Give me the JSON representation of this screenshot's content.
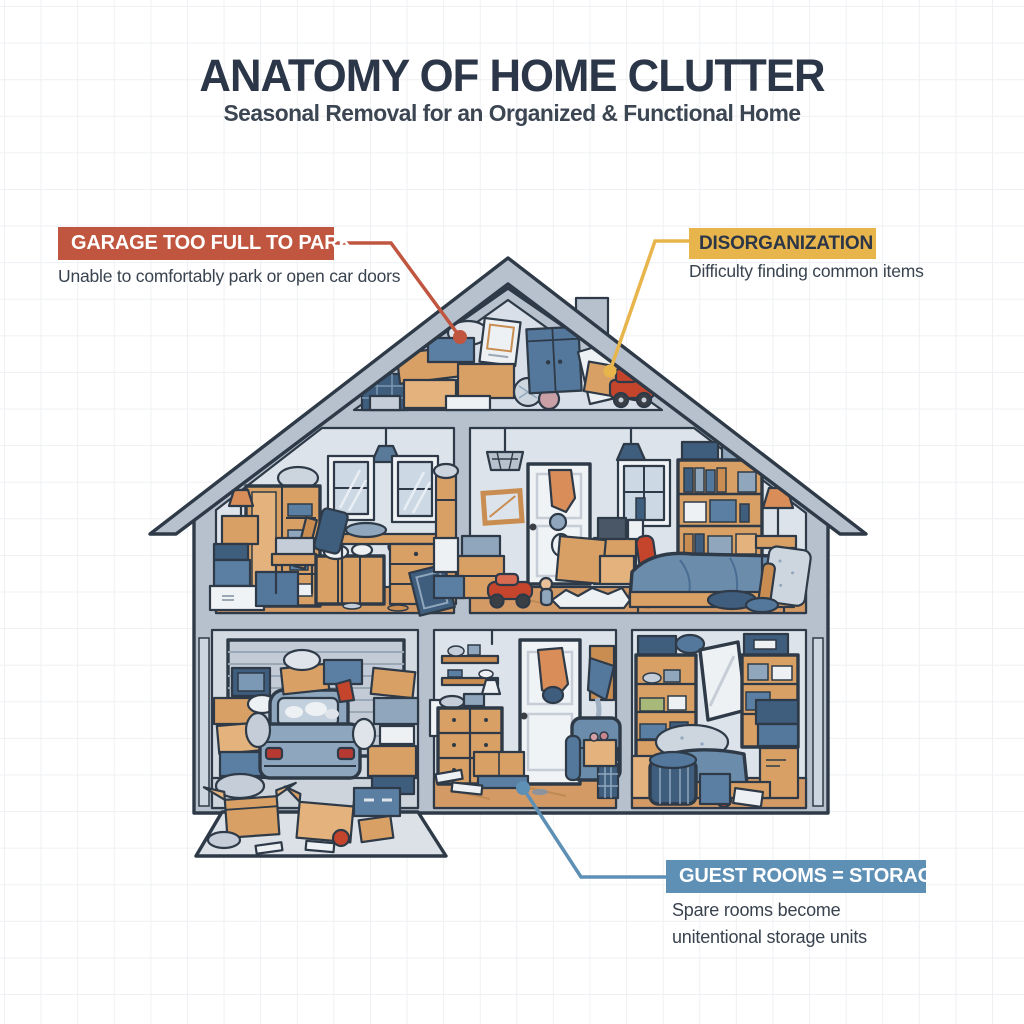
{
  "title": {
    "heading": "ANATOMY OF HOME CLUTTER",
    "subheading": "Seasonal Removal for an Organized & Functional Home"
  },
  "callouts": [
    {
      "id": "garage-too-full",
      "label": "GARAGE TOO FULL TO PARK",
      "description": "Unable to comfortably park or open car doors",
      "accent_color": "#c0563f",
      "points_to": "attic-left-clutter"
    },
    {
      "id": "disorganization",
      "label": "DISORGANIZATION",
      "description": "Difficulty finding common items",
      "accent_color": "#e8b54d",
      "points_to": "attic-right-clutter"
    },
    {
      "id": "guest-rooms-storage",
      "label": "GUEST ROOMS = STORAGE",
      "description": "Spare rooms become unitentional storage units",
      "accent_color": "#5e8fb5",
      "points_to": "hallway-floor"
    }
  ],
  "palette": {
    "heading_text": "#2b3648",
    "body_text": "#39434f",
    "outline": "#2e3a47",
    "roof_wall_gray": "#b7c0cd",
    "room_interior": "#dce3ea",
    "wood_floor": "#d49a66",
    "cardboard": "#d9a066",
    "blue_item": "#5b7fa3",
    "navy_item": "#3f5d7d",
    "toy_red": "#c4452c",
    "grid_line": "#eef0f3"
  }
}
